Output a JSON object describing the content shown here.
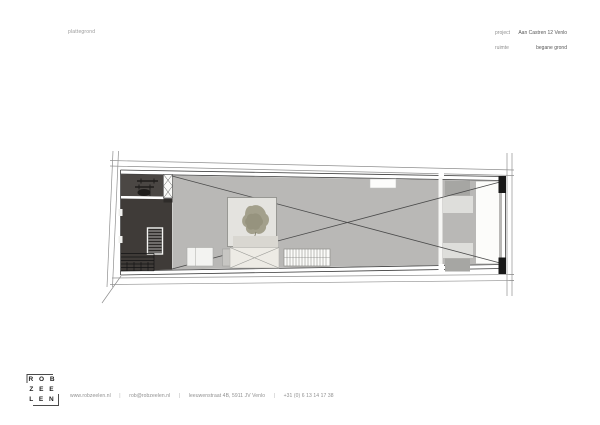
{
  "header": {
    "drawing_type": "plattegrond",
    "project_label": "project",
    "project_value": "Aan Castren 12 Venlo",
    "room_label": "ruimte",
    "room_value": "begane grond"
  },
  "palette": {
    "floor_gray": "#b9b8b6",
    "dark_zone_top": "#4b4744",
    "dark_zone_bottom": "#3f3b38",
    "patio_fill": "#e4e3df",
    "tree_olive": "#a3a08c",
    "wall_ink": "#3c3c3c",
    "cap_black": "#181818"
  },
  "logo": {
    "rows": [
      "R O B",
      "Z E E",
      "L E N"
    ]
  },
  "footer": {
    "website": "www.robzeelen.nl",
    "email": "rob@robzeelen.nl",
    "address": "leeuwenstraat 4B, 5911 JV Venlo",
    "phone": "+31 (0) 6 13 14 17 38",
    "separator": "|"
  }
}
